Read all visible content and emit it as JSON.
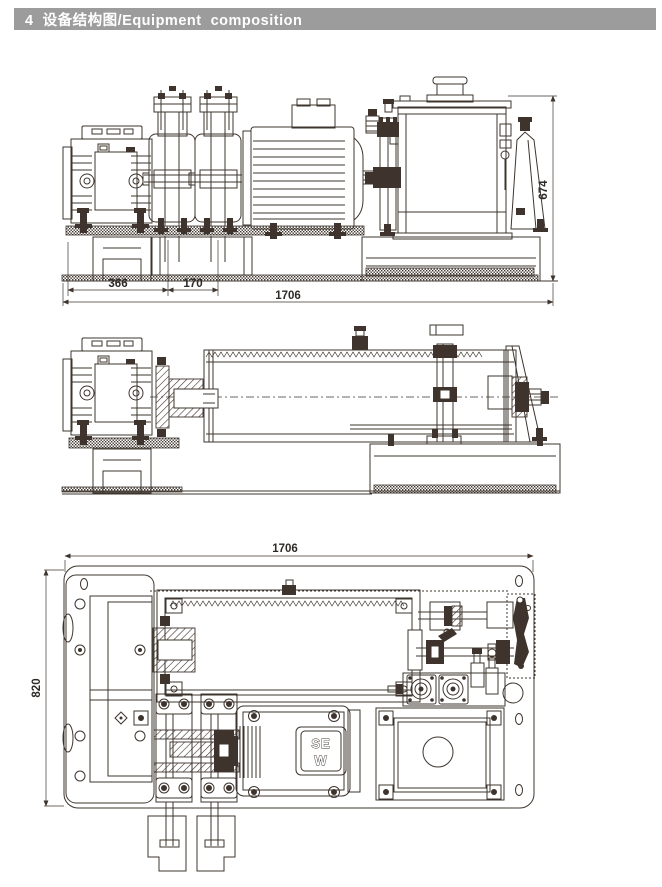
{
  "header": {
    "title": "4  设备结构图/Equipment  composition",
    "bg_color": "#9c9c9c",
    "text_color": "#ffffff"
  },
  "drawing": {
    "ink_color": "#3e342d",
    "front_view": {
      "dim_reducer_span": "366",
      "dim_bearing_span": "170",
      "dim_total_length": "1706",
      "dim_total_height": "674"
    },
    "plan_view": {
      "dim_total_length": "1706",
      "dim_total_width": "820"
    },
    "motor_brand": {
      "line1": "SE",
      "line2": "W"
    }
  }
}
